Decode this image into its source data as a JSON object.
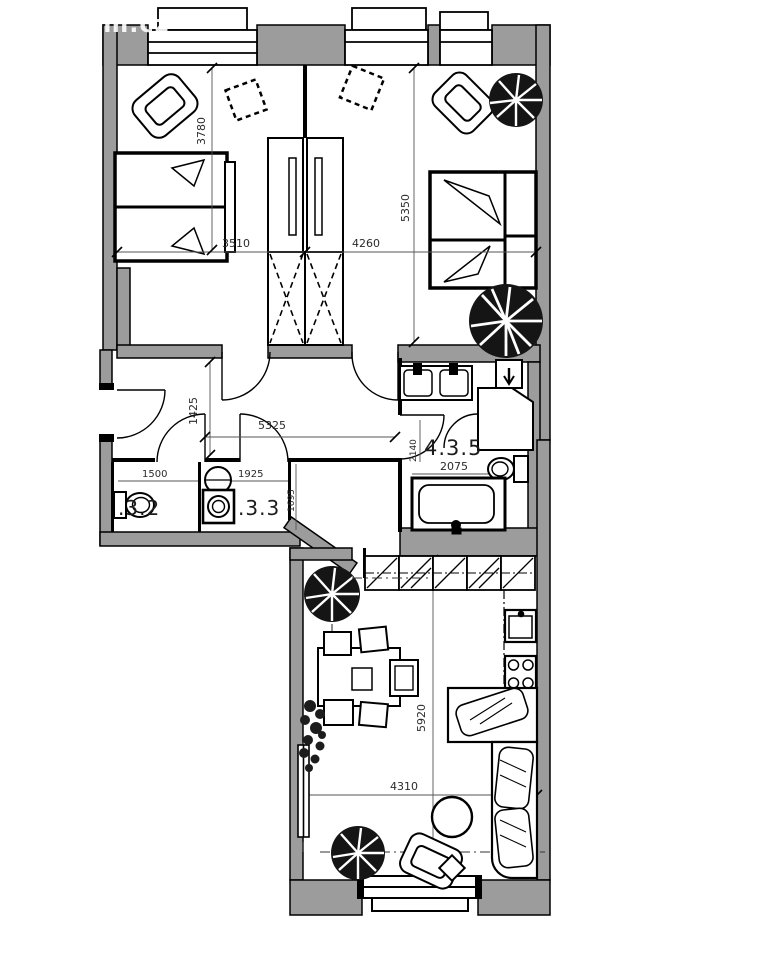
{
  "watermark": "sm.cz",
  "rooms": {
    "wc_label": ".3.2",
    "laundry_label": ".3.3",
    "bathroom_label": "4.3.5"
  },
  "dimensions": {
    "bedroom_left_width": "3510",
    "bedroom_right_width": "4260",
    "bedroom_left_depth": "3780",
    "bedroom_right_depth": "5350",
    "hallway_depth": "1425",
    "hallway_width": "5325",
    "wc_width": "1500",
    "laundry_width": "1925",
    "laundry_depth": "1695",
    "bathroom_width": "2075",
    "bathroom_depth": "2140",
    "living_depth": "5920",
    "living_width": "4310"
  },
  "colors": {
    "wall_gray": "#9c9c9c",
    "line_black": "#000000",
    "plant_dark": "#151515",
    "dim_text": "#2b2b2b"
  }
}
